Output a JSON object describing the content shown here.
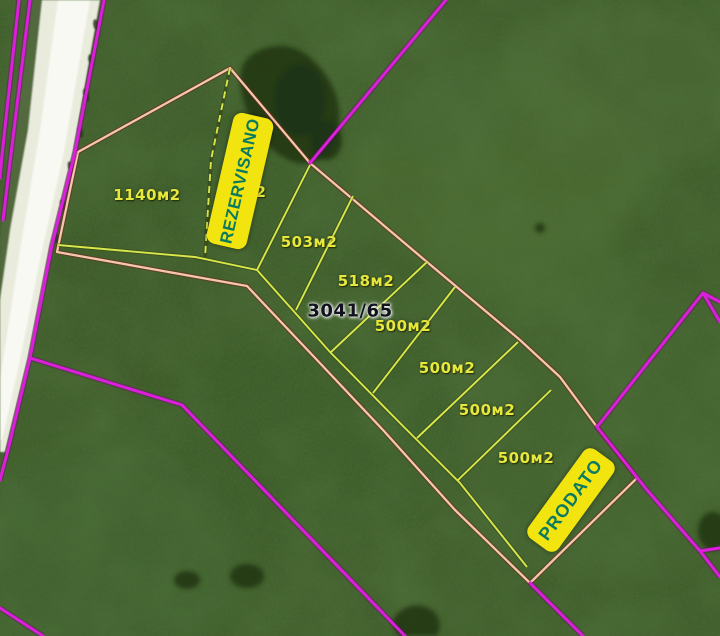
{
  "map": {
    "parcel_number": "3041/65",
    "banners": {
      "reserved": "REZERVISANO",
      "sold": "PRODATO"
    },
    "area_labels": [
      {
        "id": "area-1140",
        "text": "1140м2"
      },
      {
        "id": "area-hidden",
        "text": "2",
        "partially_hidden_by_banner": true
      },
      {
        "id": "area-503",
        "text": "503м2"
      },
      {
        "id": "area-518",
        "text": "518м2"
      },
      {
        "id": "area-500-1",
        "text": "500м2"
      },
      {
        "id": "area-500-2",
        "text": "500м2"
      },
      {
        "id": "area-500-3",
        "text": "500м2"
      },
      {
        "id": "area-500-4",
        "text": "500м2"
      }
    ],
    "colors": {
      "grass_base": "#3f5e2b",
      "magenta": "#db1edb",
      "boundary_pink": "#f6c6ae",
      "boundary_shadow": "#6b2817",
      "line_yellow": "#d8e74b",
      "label_yellow": "#e6e83b",
      "banner_yellow": "#f2e40f",
      "banner_text": "#0b7a60",
      "parcel_number_color": "#12121f",
      "road_white": "#f8f9f3"
    }
  }
}
